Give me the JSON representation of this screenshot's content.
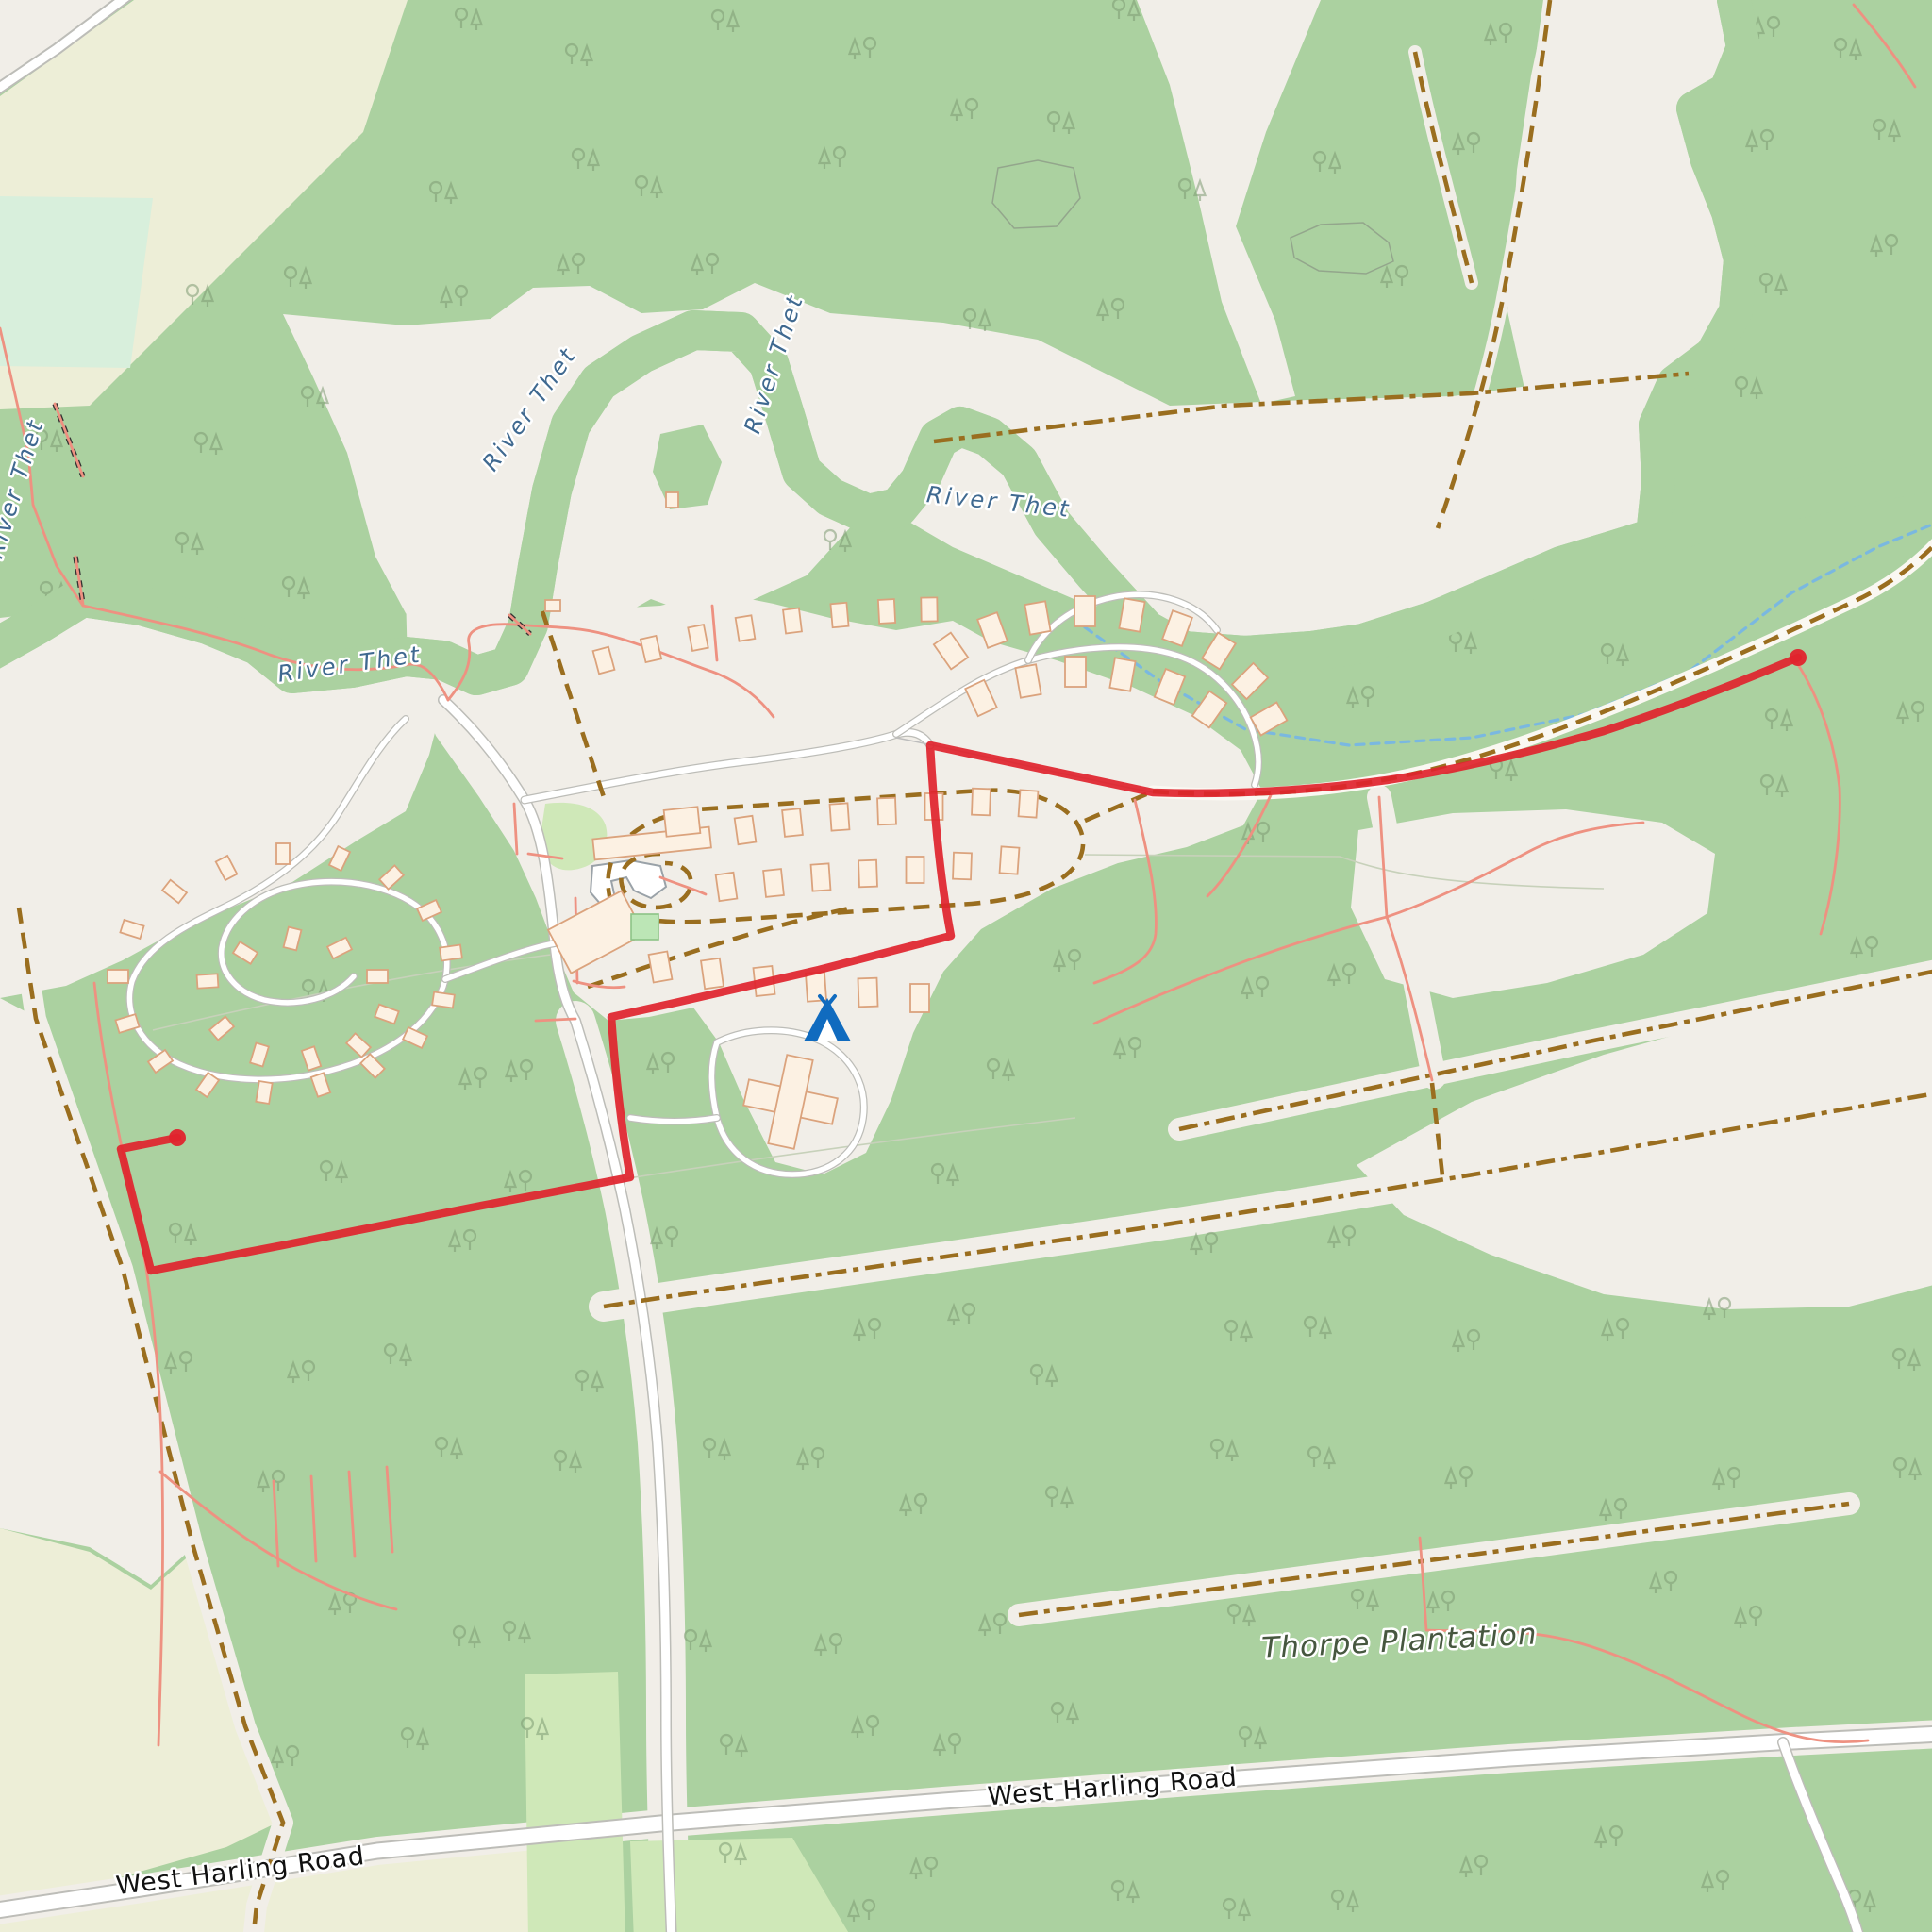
{
  "map": {
    "kind": "openstreetmap-style topographic map with GPS trace",
    "labels": {
      "river": {
        "text": "River Thet",
        "occurrences": 5
      },
      "road": {
        "text": "West Harling Road",
        "occurrences": 2
      },
      "plantation": {
        "text": "Thorpe Plantation",
        "occurrences": 1
      }
    },
    "icons": {
      "campsite": "campsite-icon"
    },
    "route": {
      "color": "#e0232d",
      "stroke_width": 8,
      "endpoints": 2
    },
    "colors": {
      "bg": "#f1eee8",
      "forest": "#abd1a0",
      "farmland": "#edeed7",
      "meadow": "#d8efdc",
      "grass": "#cfe8b8",
      "water": "#8ec9e8",
      "water_label": "#3f6990",
      "area_label": "#46573f",
      "road_casing": "#bdbdb8",
      "track": "#9a6e1f",
      "path": "#ee9181",
      "ditch": "#7ab8e0",
      "building": "#fcf1e3",
      "building_stroke": "#dba37d",
      "route": "#e0232d",
      "campsite": "#106bbf"
    }
  }
}
